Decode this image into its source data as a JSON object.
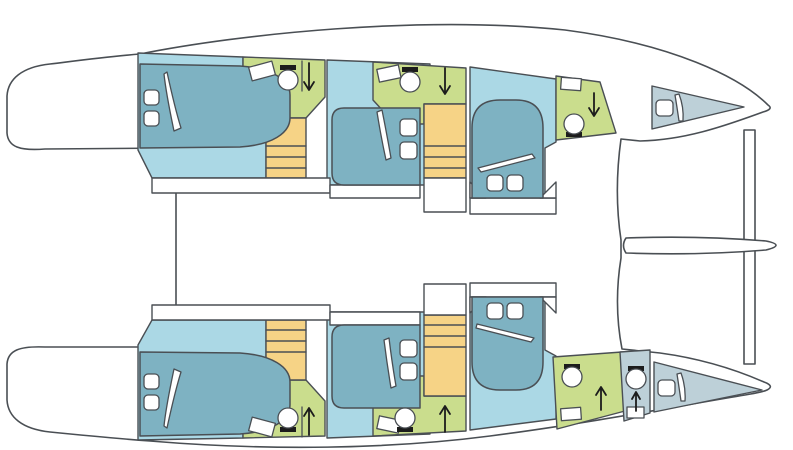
{
  "title": "Catamaran interior deck plan",
  "diagram_type": "yacht-floor-plan",
  "orientation": "bow-right",
  "colors": {
    "background": "#ffffff",
    "white": "#ffffff",
    "outline": "#4a4f54",
    "ink": "#1c1c1c",
    "cabin_floor": "#abd8e5",
    "bed": "#7eb2c2",
    "bathroom": "#cadd8d",
    "stairs": "#f6d386",
    "crew_area": "#bdd0d8"
  },
  "hulls": [
    {
      "name": "top hull",
      "rooms": [
        {
          "room": "aft double cabin",
          "furniture": [
            "double-bed",
            "pillow x2",
            "blanket-fold"
          ]
        },
        {
          "room": "aft head",
          "furniture": [
            "sink",
            "toilet",
            "shower-arrow"
          ]
        },
        {
          "room": "aft companionway stairs"
        },
        {
          "room": "mid double cabin",
          "furniture": [
            "double-bed",
            "pillow x2",
            "blanket-fold"
          ]
        },
        {
          "room": "mid head",
          "furniture": [
            "sink",
            "toilet",
            "shower-arrow"
          ]
        },
        {
          "room": "mid companionway stairs"
        },
        {
          "room": "forward double cabin",
          "furniture": [
            "double-bed",
            "pillow x2",
            "blanket-fold"
          ]
        },
        {
          "room": "forward head",
          "furniture": [
            "sink",
            "toilet",
            "shower-arrow"
          ]
        },
        {
          "room": "forepeak crew berth",
          "furniture": [
            "single-berth",
            "pillow"
          ]
        }
      ]
    },
    {
      "name": "bottom hull",
      "rooms": [
        {
          "room": "aft double cabin",
          "furniture": [
            "double-bed",
            "pillow x2",
            "blanket-fold"
          ]
        },
        {
          "room": "aft head",
          "furniture": [
            "sink",
            "toilet",
            "shower-arrow"
          ]
        },
        {
          "room": "aft companionway stairs"
        },
        {
          "room": "mid double cabin",
          "furniture": [
            "double-bed",
            "pillow x2",
            "blanket-fold"
          ]
        },
        {
          "room": "mid head",
          "furniture": [
            "sink",
            "toilet",
            "shower-arrow"
          ]
        },
        {
          "room": "mid companionway stairs"
        },
        {
          "room": "forward double cabin",
          "furniture": [
            "double-bed",
            "pillow x2",
            "blanket-fold"
          ]
        },
        {
          "room": "forward head",
          "furniture": [
            "sink",
            "toilet",
            "shower-arrow"
          ]
        },
        {
          "room": "crew head",
          "furniture": [
            "sink",
            "toilet",
            "shower-arrow"
          ]
        },
        {
          "room": "forepeak crew berth",
          "furniture": [
            "single-berth",
            "pillow"
          ]
        }
      ]
    }
  ],
  "structure": {
    "bridge_deck": true,
    "stern_swim_platforms": 2,
    "forward_crossbeam": true,
    "bowsprit_blade": true,
    "double_cabins": 6,
    "heads": 7
  }
}
